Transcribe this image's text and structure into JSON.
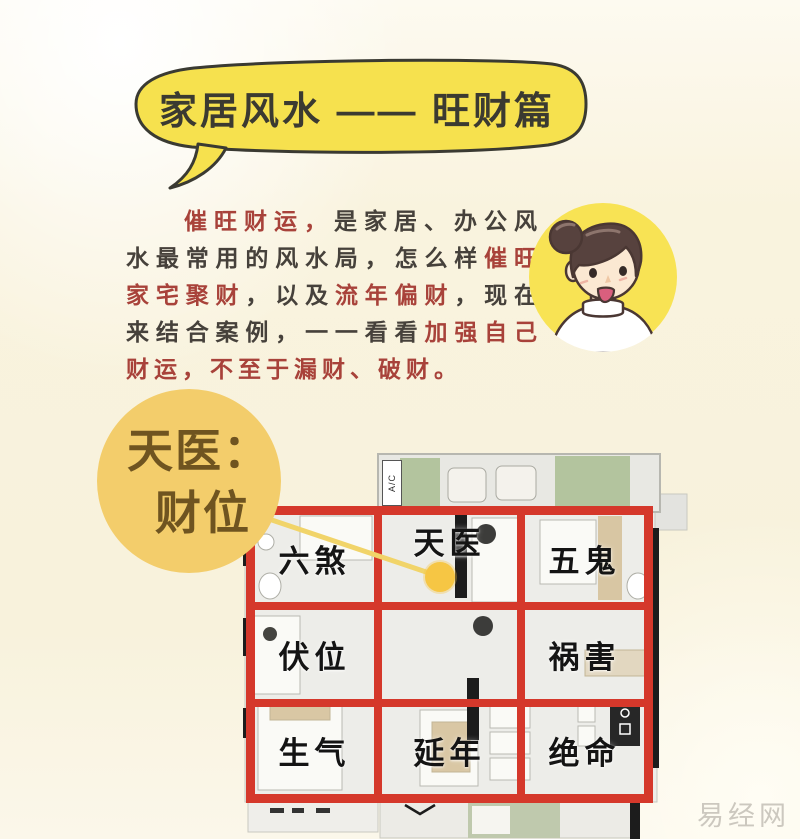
{
  "page": {
    "background_color": "#f9f3de",
    "watermark": "易经网"
  },
  "title_bubble": {
    "text": "家居风水 —— 旺财篇",
    "bubble_color": "#f6e14e",
    "outline_color": "#3a3a32",
    "text_color": "#3b3a31"
  },
  "intro": {
    "red_color": "#a8423a",
    "dark_color": "#46413b",
    "segments": [
      {
        "text": "催旺财运，",
        "color": "red"
      },
      {
        "text": "是家居、办公风水最常用的风水局，怎么样",
        "color": "dark"
      },
      {
        "text": "催旺家宅聚财",
        "color": "red"
      },
      {
        "text": "，以及",
        "color": "dark"
      },
      {
        "text": "流年偏财",
        "color": "red"
      },
      {
        "text": "，现在来结合案例，一一看看",
        "color": "dark"
      },
      {
        "text": "加强自己财运，不至于漏财、破财。",
        "color": "red"
      }
    ]
  },
  "avatar": {
    "description": "cartoon woman with hair bun on yellow circle",
    "circle_color": "#f8e354"
  },
  "callout": {
    "line1": "天医：",
    "line2": "财位",
    "circle_color": "#f3cd6b",
    "text_color": "#6f5420",
    "marker_color": "#f6c644"
  },
  "floor_plan": {
    "grid_color": "#d5382b",
    "balcony_label": "A/C",
    "cells": [
      {
        "row": 1,
        "col": 1,
        "label": "六煞"
      },
      {
        "row": 1,
        "col": 2,
        "label": "天医"
      },
      {
        "row": 1,
        "col": 3,
        "label": "五鬼"
      },
      {
        "row": 2,
        "col": 1,
        "label": "伏位"
      },
      {
        "row": 2,
        "col": 2,
        "label": ""
      },
      {
        "row": 2,
        "col": 3,
        "label": "祸害"
      },
      {
        "row": 3,
        "col": 1,
        "label": "生气"
      },
      {
        "row": 3,
        "col": 2,
        "label": "延年"
      },
      {
        "row": 3,
        "col": 3,
        "label": "绝命"
      }
    ]
  }
}
